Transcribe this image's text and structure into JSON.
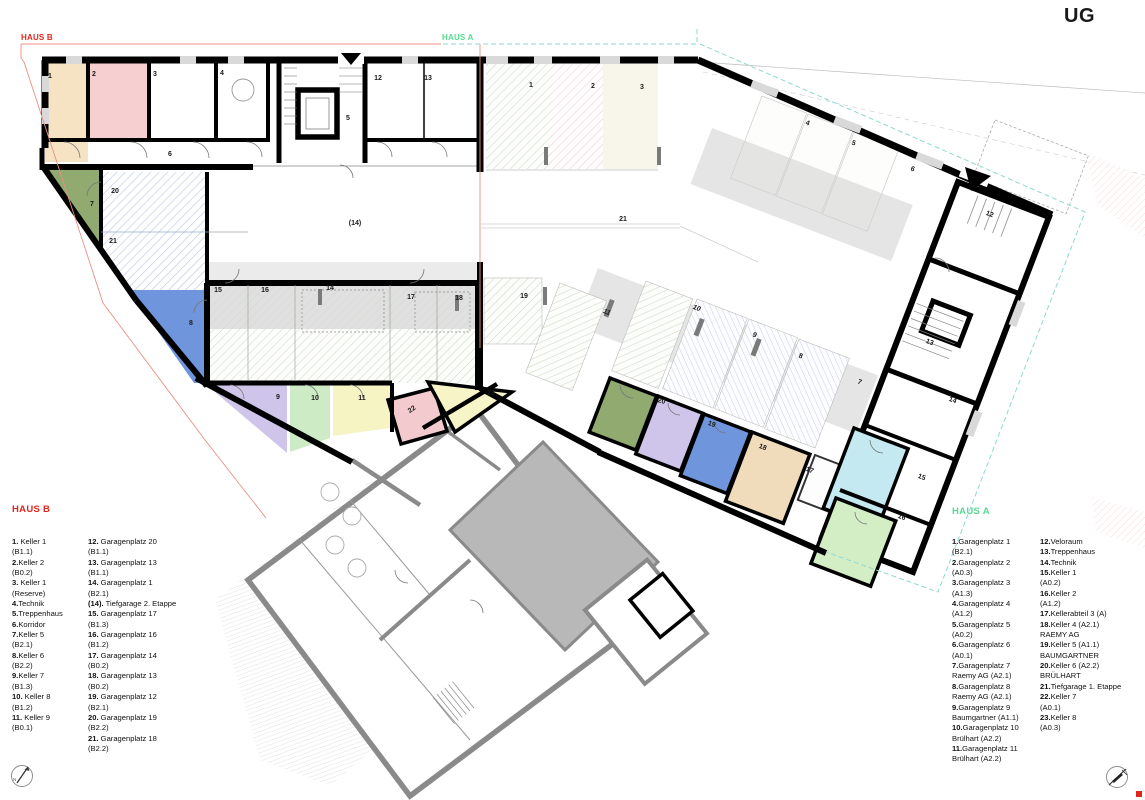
{
  "title": "UG",
  "colors": {
    "haus_b_accent": "#e0261a",
    "haus_a_accent": "#55db92",
    "wall_new": "#000000",
    "wall_existing": "#8a8a8a",
    "boundary_red": "#ea8f85",
    "boundary_teal": "#8fd8d2",
    "room_fills": {
      "b_keller1": "#f6e3c3",
      "b_keller2": "#f6d0d0",
      "b_keller5": "#90aa70",
      "b_keller6": "#6f96dd",
      "b_keller7": "#cfc5ea",
      "b_keller8": "#cdebc4",
      "b_keller9": "#f7f4c4",
      "b_22": "#f3cbce",
      "b_23": "#f7f4c8",
      "a_keller6": "#90aa70",
      "a_keller5": "#cfc5ea",
      "a_keller4": "#6f96dd",
      "a_kellerabteil3": "#f0dcba",
      "a_keller1": "#c4e9f0",
      "a_keller2": "#d3edc5"
    }
  },
  "plan": {
    "haus_b_tag": "HAUS B",
    "haus_a_tag": "HAUS A",
    "room_labels_b": [
      {
        "t": "1",
        "x": 50,
        "y": 78
      },
      {
        "t": "2",
        "x": 94,
        "y": 76
      },
      {
        "t": "3",
        "x": 155,
        "y": 76
      },
      {
        "t": "4",
        "x": 222,
        "y": 75
      },
      {
        "t": "5",
        "x": 348,
        "y": 120
      },
      {
        "t": "6",
        "x": 170,
        "y": 156
      },
      {
        "t": "12",
        "x": 378,
        "y": 80
      },
      {
        "t": "13",
        "x": 428,
        "y": 80
      },
      {
        "t": "20",
        "x": 115,
        "y": 193
      },
      {
        "t": "21",
        "x": 113,
        "y": 243
      },
      {
        "t": "(14)",
        "x": 355,
        "y": 225
      },
      {
        "t": "7",
        "x": 92,
        "y": 206
      },
      {
        "t": "8",
        "x": 191,
        "y": 325
      },
      {
        "t": "15",
        "x": 218,
        "y": 292
      },
      {
        "t": "16",
        "x": 265,
        "y": 292
      },
      {
        "t": "14",
        "x": 330,
        "y": 290
      },
      {
        "t": "17",
        "x": 411,
        "y": 299
      },
      {
        "t": "18",
        "x": 459,
        "y": 300
      },
      {
        "t": "9",
        "x": 278,
        "y": 399
      },
      {
        "t": "10",
        "x": 315,
        "y": 400
      },
      {
        "t": "11",
        "x": 362,
        "y": 400
      },
      {
        "t": "22",
        "x": 413,
        "y": 411,
        "r": -35
      },
      {
        "t": "23",
        "x": 491,
        "y": 395
      }
    ],
    "room_labels_a": [
      {
        "t": "1",
        "x": 531,
        "y": 87
      },
      {
        "t": "2",
        "x": 593,
        "y": 88
      },
      {
        "t": "3",
        "x": 642,
        "y": 89
      },
      {
        "t": "4",
        "x": 807,
        "y": 125,
        "r": 21
      },
      {
        "t": "5",
        "x": 853,
        "y": 145,
        "r": 21
      },
      {
        "t": "6",
        "x": 912,
        "y": 171,
        "r": 21
      },
      {
        "t": "21",
        "x": 623,
        "y": 221
      },
      {
        "t": "19",
        "x": 524,
        "y": 298
      },
      {
        "t": "11",
        "x": 606,
        "y": 314,
        "r": 21,
        "i": 1
      },
      {
        "t": "10",
        "x": 696,
        "y": 310,
        "r": 21,
        "i": 1
      },
      {
        "t": "9",
        "x": 754,
        "y": 337,
        "r": 21
      },
      {
        "t": "8",
        "x": 800,
        "y": 358,
        "r": 21
      },
      {
        "t": "7",
        "x": 859,
        "y": 384,
        "r": 21
      },
      {
        "t": "12",
        "x": 989,
        "y": 216,
        "r": 21
      },
      {
        "t": "13",
        "x": 929,
        "y": 344,
        "r": 21
      },
      {
        "t": "14",
        "x": 952,
        "y": 402,
        "r": 21
      },
      {
        "t": "15",
        "x": 921,
        "y": 479,
        "r": 21
      },
      {
        "t": "16",
        "x": 901,
        "y": 519,
        "r": 21
      },
      {
        "t": "17",
        "x": 809,
        "y": 472,
        "r": 21
      },
      {
        "t": "18",
        "x": 762,
        "y": 449,
        "r": 21
      },
      {
        "t": "19",
        "x": 711,
        "y": 426,
        "r": 21
      },
      {
        "t": "20",
        "x": 661,
        "y": 403,
        "r": 15
      }
    ]
  },
  "legend_haus_b": {
    "title": "HAUS B",
    "columns": [
      [
        {
          "n": "1.",
          "t": " Keller 1"
        },
        {
          "t": "(B1.1)"
        },
        {
          "n": "2.",
          "t": "Keller 2"
        },
        {
          "t": "(B0.2)"
        },
        {
          "n": "3.",
          "t": " Keller 1"
        },
        {
          "t": "(Reserve)"
        },
        {
          "n": "4.",
          "t": "Technik"
        },
        {
          "n": "5.",
          "t": "Treppenhaus"
        },
        {
          "n": "6.",
          "t": "Korridor"
        },
        {
          "n": "7.",
          "t": "Keller 5"
        },
        {
          "t": "(B2.1)"
        },
        {
          "n": "8.",
          "t": "Keller 6"
        },
        {
          "t": "(B2.2)"
        },
        {
          "n": "9.",
          "t": "Keller 7"
        },
        {
          "t": "(B1.3)"
        },
        {
          "n": "10.",
          "t": " Keller 8"
        },
        {
          "t": "(B1.2)"
        },
        {
          "n": "11.",
          "t": " Keller 9"
        },
        {
          "t": "(B0.1)"
        }
      ],
      [
        {
          "n": "12.",
          "t": " Garagenplatz 20"
        },
        {
          "t": "(B1.1)"
        },
        {
          "n": "13.",
          "t": " Garagenplatz 13"
        },
        {
          "t": "(B1.1)"
        },
        {
          "n": "14.",
          "t": " Garagenplatz 1"
        },
        {
          "t": "(B2.1)"
        },
        {
          "n": "(14).",
          "t": " Tiefgarage 2. Etappe"
        },
        {
          "n": "15.",
          "t": " Garagenplatz 17"
        },
        {
          "t": "(B1.3)"
        },
        {
          "n": "16.",
          "t": " Garagenplatz 16"
        },
        {
          "t": "(B1.2)"
        },
        {
          "n": "17.",
          "t": " Garagenplatz 14"
        },
        {
          "t": "(B0.2)"
        },
        {
          "n": "18.",
          "t": " Garagenplatz 13"
        },
        {
          "t": "(B0.2)"
        },
        {
          "n": "19.",
          "t": " Garagenplatz 12"
        },
        {
          "t": "(B2.1)"
        },
        {
          "n": "20.",
          "t": " Garagenplatz 19"
        },
        {
          "t": "(B2.2)"
        },
        {
          "n": "21.",
          "t": " Garagenplatz 18"
        },
        {
          "t": "(B2.2)"
        }
      ]
    ]
  },
  "legend_haus_a": {
    "title": "HAUS A",
    "columns": [
      [
        {
          "n": "1.",
          "t": "Garagenplatz 1"
        },
        {
          "t": "(B2.1)"
        },
        {
          "n": "2.",
          "t": "Garagenplatz 2"
        },
        {
          "t": "(A0.3)"
        },
        {
          "n": "3.",
          "t": "Garagenplatz 3"
        },
        {
          "t": "(A1.3)"
        },
        {
          "n": "4.",
          "t": "Garagenplatz 4"
        },
        {
          "t": "(A1.2)"
        },
        {
          "n": "5.",
          "t": "Garagenplatz 5"
        },
        {
          "t": "(A0.2)"
        },
        {
          "n": "6.",
          "t": "Garagenplatz 6"
        },
        {
          "t": "(A0.1)"
        },
        {
          "n": "7.",
          "t": "Garagenplatz 7"
        },
        {
          "t": "Raemy AG (A2.1)"
        },
        {
          "n": "8.",
          "t": "Garagenplatz 8"
        },
        {
          "t": "Raemy AG (A2.1)"
        },
        {
          "n": "9.",
          "t": "Garagenplatz 9"
        },
        {
          "t": "Baumgartner (A1.1)"
        },
        {
          "n": "10.",
          "t": "Garagenplatz 10"
        },
        {
          "t": "Brülhart (A2.2)"
        },
        {
          "n": "11.",
          "t": "Garagenplatz 11"
        },
        {
          "t": "Brülhart (A2.2)"
        }
      ],
      [
        {
          "n": "12.",
          "t": "Veloraum"
        },
        {
          "n": "13.",
          "t": "Treppenhaus"
        },
        {
          "n": "14.",
          "t": "Technik"
        },
        {
          "n": "15.",
          "t": "Keller 1"
        },
        {
          "t": "(A0.2)"
        },
        {
          "n": "16.",
          "t": "Keller 2"
        },
        {
          "t": "(A1.2)"
        },
        {
          "n": "17.",
          "t": "Kellerabteil 3 (A)"
        },
        {
          "n": "18.",
          "t": "Keller 4 (A2.1)"
        },
        {
          "t": "RAEMY AG"
        },
        {
          "n": "19.",
          "t": "Keller 5 (A1.1)"
        },
        {
          "t": "BAUMGARTNER"
        },
        {
          "n": "20.",
          "t": "Keller 6 (A2.2)"
        },
        {
          "t": "BRÜLHART"
        },
        {
          "n": "21.",
          "t": "Tiefgarage 1. Etappe"
        },
        {
          "n": "22.",
          "t": "Keller 7"
        },
        {
          "t": "(A0.1)"
        },
        {
          "n": "23.",
          "t": "Keller 8"
        },
        {
          "t": "(A0.3)"
        }
      ]
    ]
  }
}
